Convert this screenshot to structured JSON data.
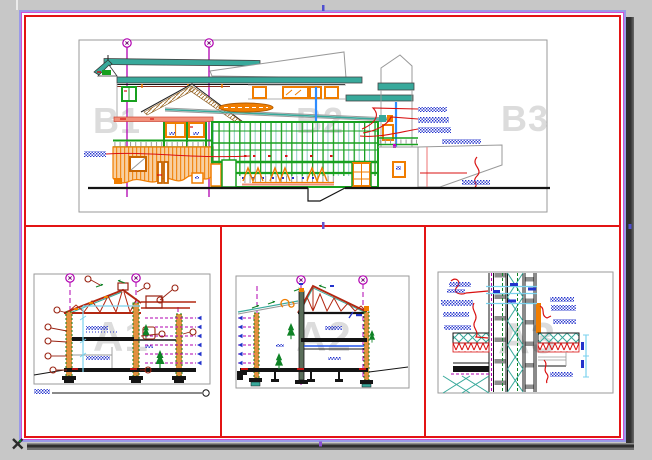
{
  "app": {
    "background": "#c7c7c7"
  },
  "paper": {
    "fill": "#ffffff",
    "shadow": "#3c3c3c",
    "selected": true
  },
  "selection": {
    "outline_color": "#9a9ae8",
    "accent_color": "#d34fd3",
    "grip_color": "#4f4fd0",
    "grips": [
      "bottom-left-cross",
      "top-mid",
      "center",
      "bottom-mid",
      "right-mid"
    ]
  },
  "sheet": {
    "frame_color": "#e31414",
    "watermarks": {
      "b1": "B1",
      "b2": "B2",
      "b3": "B3",
      "a1": "A1",
      "a2": "A2",
      "a3": "A3"
    }
  },
  "palette": {
    "teal": "#38a99b",
    "green": "#18a01f",
    "orange": "#f07d00",
    "peach": "#f8cfa0",
    "salmon": "#f2907a",
    "red": "#d91111",
    "truss_red": "#b32812",
    "marker_red": "#992211",
    "grid_magenta": "#b100b1",
    "note_blue": "#2333cc",
    "dim_cyan": "#7ad2ee",
    "roof_brown": "#a97a3a",
    "outline_gray": "#9a9a9a",
    "ink": "#141414",
    "watermark_gray": "#dcdcdc"
  }
}
